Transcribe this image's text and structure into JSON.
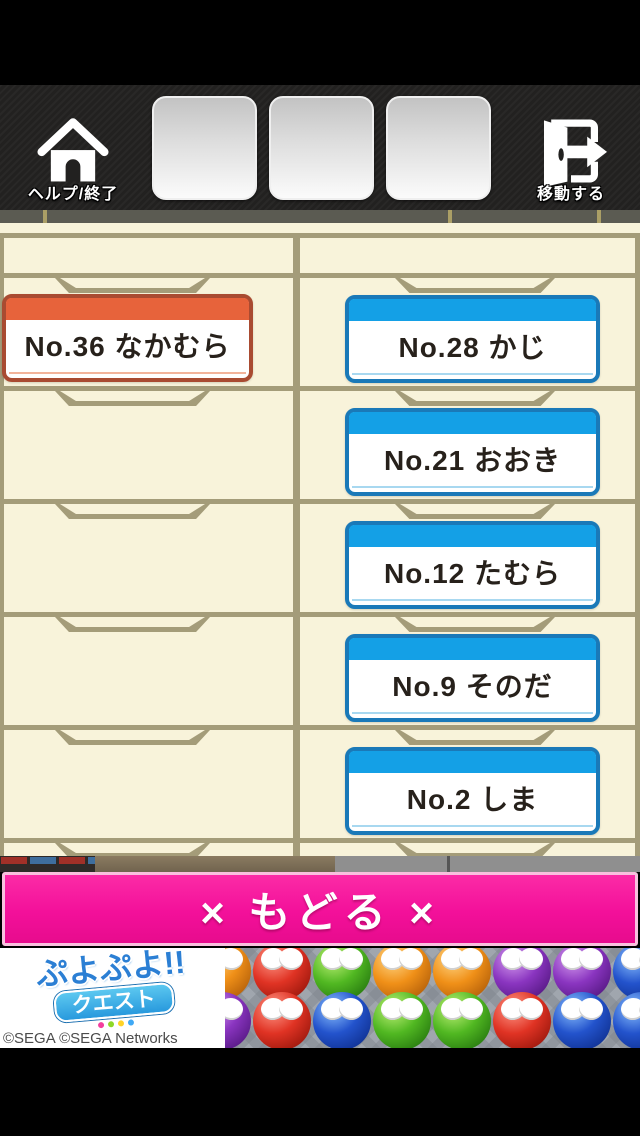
{
  "toolbar": {
    "home": {
      "label": "ヘルプ/終了"
    },
    "move": {
      "label": "移動する"
    }
  },
  "locker": {
    "left_tags": [
      {
        "label": "No.36 なかむら",
        "color": "orange"
      }
    ],
    "right_tags": [
      {
        "label": "No.28 かじ",
        "color": "blue"
      },
      {
        "label": "No.21 おおき",
        "color": "blue"
      },
      {
        "label": "No.12 たむら",
        "color": "blue"
      },
      {
        "label": "No.9 そのだ",
        "color": "blue"
      },
      {
        "label": "No.2 しま",
        "color": "blue"
      }
    ]
  },
  "back_button": {
    "label": "× もどる ×"
  },
  "ad": {
    "logo_line1": "ぷよぷよ!!",
    "logo_line2": "クエスト",
    "copyright": "©SEGA ©SEGA Networks",
    "puyo_rows": [
      [
        "orange",
        "red",
        "green",
        "orange",
        "orange",
        "purple",
        "purple",
        "blue"
      ],
      [
        "purple",
        "red",
        "blue",
        "green",
        "green",
        "red",
        "blue",
        "blue"
      ]
    ]
  },
  "colors": {
    "accent_pink": "#f3109a",
    "tag_blue_header": "#14a0e6",
    "tag_blue_border": "#1a79b8",
    "tag_orange_header": "#e7633b",
    "tag_orange_border": "#a94b31",
    "cabinet_cream": "#f8f3da",
    "cabinet_line": "#a49c79"
  }
}
